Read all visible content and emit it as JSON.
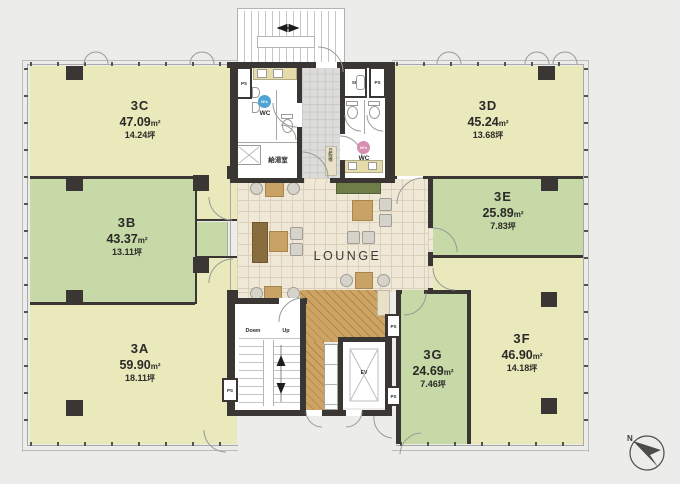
{
  "units": [
    {
      "id": "3A",
      "area": "59.90",
      "area_unit": "m²",
      "tsubo": "18.11",
      "tsubo_unit": "坪"
    },
    {
      "id": "3B",
      "area": "43.37",
      "area_unit": "m²",
      "tsubo": "13.11",
      "tsubo_unit": "坪"
    },
    {
      "id": "3C",
      "area": "47.09",
      "area_unit": "m²",
      "tsubo": "14.24",
      "tsubo_unit": "坪"
    },
    {
      "id": "3D",
      "area": "45.24",
      "area_unit": "m²",
      "tsubo": "13.68",
      "tsubo_unit": "坪"
    },
    {
      "id": "3E",
      "area": "25.89",
      "area_unit": "m²",
      "tsubo": "7.83",
      "tsubo_unit": "坪"
    },
    {
      "id": "3F",
      "area": "46.90",
      "area_unit": "m²",
      "tsubo": "14.18",
      "tsubo_unit": "坪"
    },
    {
      "id": "3G",
      "area": "24.69",
      "area_unit": "m²",
      "tsubo": "7.46",
      "tsubo_unit": "坪"
    }
  ],
  "lounge": {
    "label": "LOUNGE"
  },
  "core": {
    "kitchenette": "給湯室",
    "mens_badge": "M's",
    "womens_badge": "W's",
    "wc": "WC",
    "pipe_shaft": "PS",
    "slop_sink": "SK",
    "elevator": "EV",
    "stair_down": "Down",
    "stair_up": "Up",
    "vending": "自販機"
  },
  "compass": {
    "north": "N"
  },
  "colors": {
    "unit_pale": "#e9e9bb",
    "unit_green": "#c6d9a6",
    "lounge_floor": "#f0e8d6",
    "wood_floor": "#c79e5d",
    "wall": "#3a3633",
    "corridor": "#dcdcda",
    "mens_blue": "#4fa3d5",
    "womens_pink": "#d78fb1",
    "background": "#ececea"
  }
}
